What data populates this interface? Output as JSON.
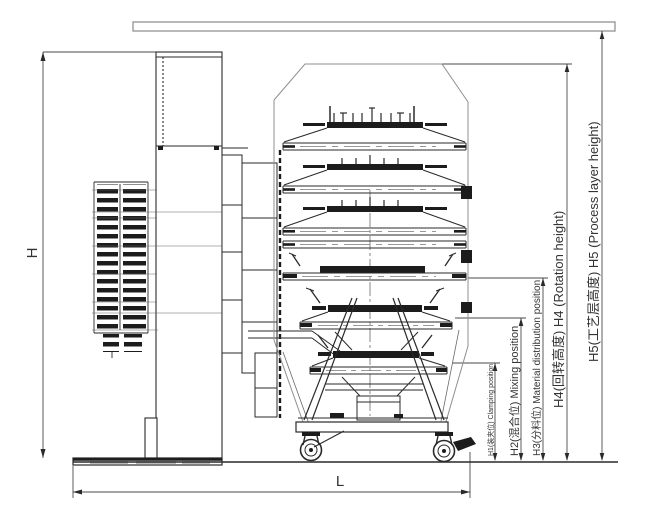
{
  "drawing": {
    "dimensions": {
      "height_label": "H",
      "length_label": "L",
      "h1_label": "H1(装夹位) Clamping position",
      "h2_label": "H2(混合位) Mixing position",
      "h3_label": "H3(分料位) Material distribution position",
      "h4_label": "H4(回转高度) H4 (Rotation height)",
      "h5_label": "H5(工艺层高度) H5 (Process layer height)"
    },
    "colors": {
      "machine_line": "#2a2a2a",
      "envelope_line": "#8f8f8f",
      "dimension_line": "#4a4a4a",
      "label_text": "#333333",
      "background": "#ffffff"
    }
  }
}
